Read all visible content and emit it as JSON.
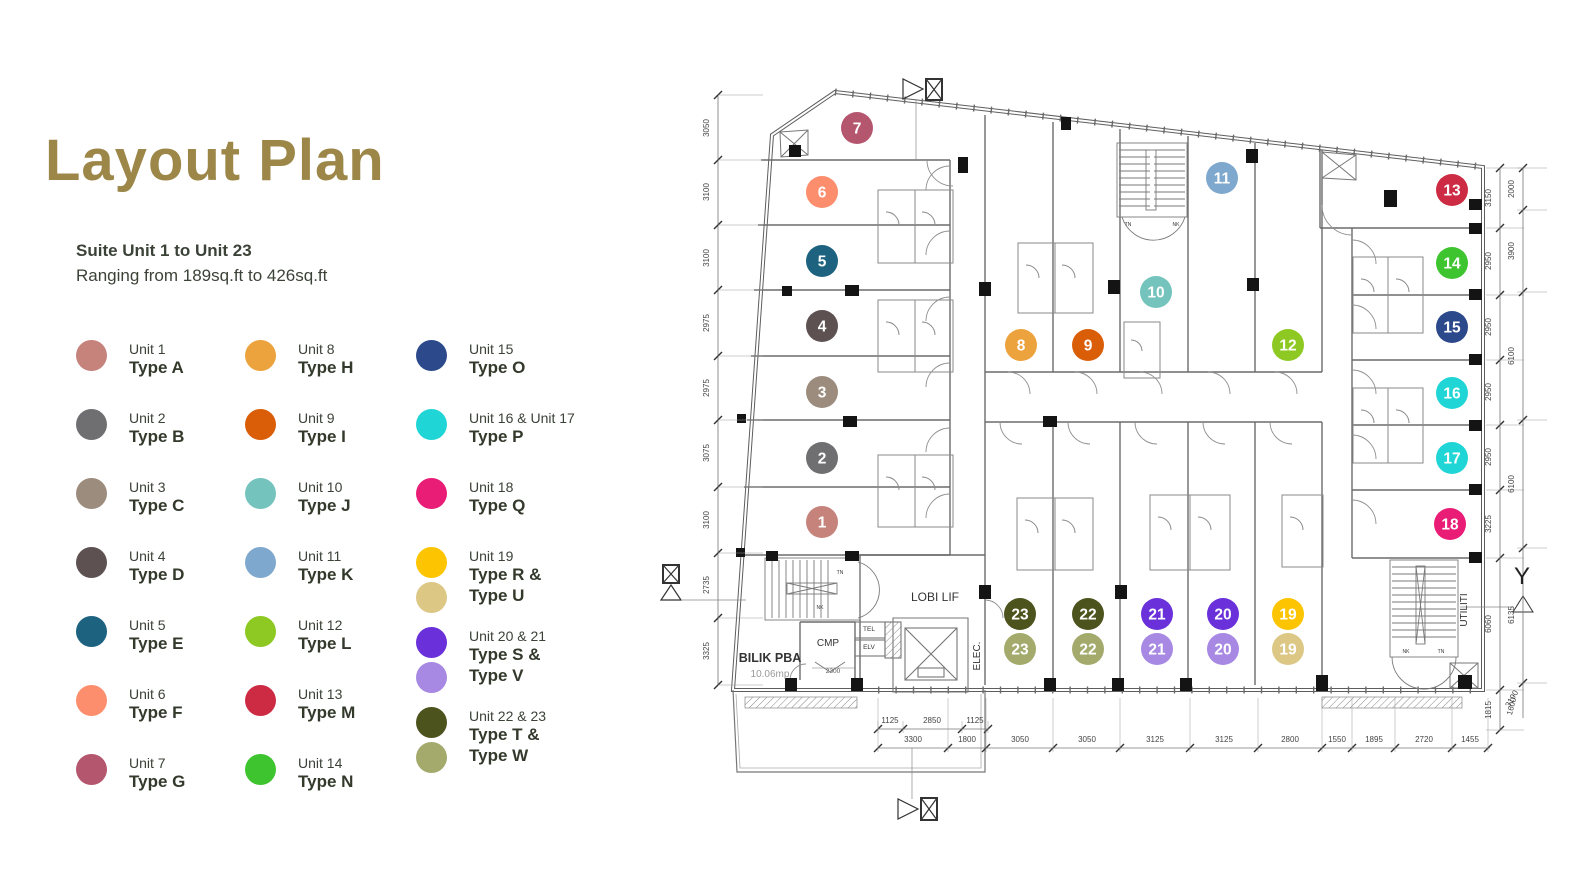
{
  "title": "Layout Plan",
  "title_color": "#9c8748",
  "subtitle": {
    "line1": "Suite Unit 1 to Unit 23",
    "line2": "Ranging from 189sq.ft to 426sq.ft"
  },
  "legend": {
    "columns": [
      [
        {
          "unit": "Unit 1",
          "types": [
            "Type A"
          ],
          "colors": [
            "#c5837b"
          ]
        },
        {
          "unit": "Unit 2",
          "types": [
            "Type B"
          ],
          "colors": [
            "#6f6f71"
          ]
        },
        {
          "unit": "Unit 3",
          "types": [
            "Type C"
          ],
          "colors": [
            "#9c8c7e"
          ]
        },
        {
          "unit": "Unit 4",
          "types": [
            "Type D"
          ],
          "colors": [
            "#5d5152"
          ]
        },
        {
          "unit": "Unit 5",
          "types": [
            "Type E"
          ],
          "colors": [
            "#1d6380"
          ]
        },
        {
          "unit": "Unit 6",
          "types": [
            "Type F"
          ],
          "colors": [
            "#fc8e6e"
          ]
        },
        {
          "unit": "Unit 7",
          "types": [
            "Type G"
          ],
          "colors": [
            "#b5566f"
          ]
        }
      ],
      [
        {
          "unit": "Unit 8",
          "types": [
            "Type H"
          ],
          "colors": [
            "#eca33d"
          ]
        },
        {
          "unit": "Unit 9",
          "types": [
            "Type I"
          ],
          "colors": [
            "#da5d08"
          ]
        },
        {
          "unit": "Unit 10",
          "types": [
            "Type J"
          ],
          "colors": [
            "#74c3bc"
          ]
        },
        {
          "unit": "Unit 11",
          "types": [
            "Type K"
          ],
          "colors": [
            "#7ea8cd"
          ]
        },
        {
          "unit": "Unit 12",
          "types": [
            "Type L"
          ],
          "colors": [
            "#8dc922"
          ]
        },
        {
          "unit": "Unit 13",
          "types": [
            "Type M"
          ],
          "colors": [
            "#cd2b43"
          ]
        },
        {
          "unit": "Unit 14",
          "types": [
            "Type N"
          ],
          "colors": [
            "#3ec42f"
          ]
        }
      ],
      [
        {
          "unit": "Unit 15",
          "types": [
            "Type O"
          ],
          "colors": [
            "#2c4a8b"
          ]
        },
        {
          "unit": "Unit 16 & Unit 17",
          "types": [
            "Type P"
          ],
          "colors": [
            "#20d5d5"
          ]
        },
        {
          "unit": "Unit 18",
          "types": [
            "Type Q"
          ],
          "colors": [
            "#e91d76"
          ]
        },
        {
          "unit": "Unit 19",
          "types": [
            "Type R &",
            "Type U"
          ],
          "colors": [
            "#fdc501",
            "#dcc785"
          ]
        },
        {
          "unit": "Unit 20 & 21",
          "types": [
            "Type S &",
            "Type V"
          ],
          "colors": [
            "#6a31da",
            "#a788e2"
          ]
        },
        {
          "unit": "Unit 22 & 23",
          "types": [
            "Type T &",
            "Type W"
          ],
          "colors": [
            "#4d531d",
            "#a4aa6c"
          ]
        }
      ]
    ]
  },
  "plan": {
    "markers": [
      {
        "n": "1",
        "x": 822,
        "y": 522,
        "c": "#c5837b"
      },
      {
        "n": "2",
        "x": 822,
        "y": 458,
        "c": "#6f6f71"
      },
      {
        "n": "3",
        "x": 822,
        "y": 392,
        "c": "#9c8c7e"
      },
      {
        "n": "4",
        "x": 822,
        "y": 326,
        "c": "#5d5152"
      },
      {
        "n": "5",
        "x": 822,
        "y": 261,
        "c": "#1d6380"
      },
      {
        "n": "6",
        "x": 822,
        "y": 192,
        "c": "#fc8e6e"
      },
      {
        "n": "7",
        "x": 857,
        "y": 128,
        "c": "#b5566f"
      },
      {
        "n": "8",
        "x": 1021,
        "y": 345,
        "c": "#eca33d"
      },
      {
        "n": "9",
        "x": 1088,
        "y": 345,
        "c": "#da5d08"
      },
      {
        "n": "10",
        "x": 1156,
        "y": 292,
        "c": "#74c3bc"
      },
      {
        "n": "11",
        "x": 1222,
        "y": 178,
        "c": "#7ea8cd"
      },
      {
        "n": "12",
        "x": 1288,
        "y": 345,
        "c": "#8dc922"
      },
      {
        "n": "13",
        "x": 1452,
        "y": 190,
        "c": "#cd2b43"
      },
      {
        "n": "14",
        "x": 1452,
        "y": 263,
        "c": "#3ec42f"
      },
      {
        "n": "15",
        "x": 1452,
        "y": 327,
        "c": "#2c4a8b"
      },
      {
        "n": "16",
        "x": 1452,
        "y": 393,
        "c": "#20d5d5"
      },
      {
        "n": "17",
        "x": 1452,
        "y": 458,
        "c": "#20d5d5"
      },
      {
        "n": "18",
        "x": 1450,
        "y": 524,
        "c": "#e91d76"
      },
      {
        "n": "19",
        "x": 1288,
        "y": 614,
        "c": "#fdc501"
      },
      {
        "n": "19",
        "x": 1288,
        "y": 649,
        "c": "#dcc785"
      },
      {
        "n": "20",
        "x": 1223,
        "y": 614,
        "c": "#6a31da"
      },
      {
        "n": "20",
        "x": 1223,
        "y": 649,
        "c": "#a788e2"
      },
      {
        "n": "21",
        "x": 1157,
        "y": 614,
        "c": "#6a31da"
      },
      {
        "n": "21",
        "x": 1157,
        "y": 649,
        "c": "#a788e2"
      },
      {
        "n": "22",
        "x": 1088,
        "y": 614,
        "c": "#4d531d"
      },
      {
        "n": "22",
        "x": 1088,
        "y": 649,
        "c": "#a4aa6c"
      },
      {
        "n": "23",
        "x": 1020,
        "y": 614,
        "c": "#4d531d"
      },
      {
        "n": "23",
        "x": 1020,
        "y": 649,
        "c": "#a4aa6c"
      }
    ],
    "labels": [
      {
        "t": "LOBI LIF",
        "x": 935,
        "y": 601,
        "s": 12
      },
      {
        "t": "CMP",
        "x": 828,
        "y": 646,
        "s": 10
      },
      {
        "t": "TEL",
        "x": 869,
        "y": 631,
        "s": 6.5
      },
      {
        "t": "ELV",
        "x": 869,
        "y": 649,
        "s": 6.5
      },
      {
        "t": "BILIK PBA",
        "x": 770,
        "y": 662,
        "s": 12.5,
        "w": "bold"
      },
      {
        "t": "10.06mp",
        "x": 770,
        "y": 677,
        "s": 10,
        "c": "#9a9a9a"
      },
      {
        "t": "2300",
        "x": 833,
        "y": 673,
        "s": 6.5,
        "c": "#555"
      },
      {
        "t": "ELEC.",
        "x": 980,
        "y": 656,
        "s": 10,
        "rot": -90
      },
      {
        "t": "UTILITI",
        "x": 1467,
        "y": 610,
        "s": 10,
        "rot": -90
      },
      {
        "t": "Y",
        "x": 1522,
        "y": 584,
        "s": 24,
        "c": "#222"
      },
      {
        "t": "TN",
        "x": 1128,
        "y": 226,
        "s": 5
      },
      {
        "t": "NK",
        "x": 1176,
        "y": 226,
        "s": 5
      },
      {
        "t": "TN",
        "x": 840,
        "y": 574,
        "s": 5
      },
      {
        "t": "NK",
        "x": 820,
        "y": 609,
        "s": 5
      },
      {
        "t": "NK",
        "x": 1406,
        "y": 653,
        "s": 5
      },
      {
        "t": "TN",
        "x": 1441,
        "y": 653,
        "s": 5
      }
    ],
    "dims": {
      "left": {
        "dir": "v",
        "x": 718,
        "y1": 95,
        "y2": 685,
        "ext": [
          0,
          27
        ],
        "ticks": [
          95,
          160,
          225,
          290,
          356,
          420,
          487,
          553,
          618,
          685
        ],
        "labels": [
          {
            "v": "3050",
            "p": 128
          },
          {
            "v": "3100",
            "p": 192
          },
          {
            "v": "3100",
            "p": 258
          },
          {
            "v": "2975",
            "p": 323
          },
          {
            "v": "2975",
            "p": 388
          },
          {
            "v": "3075",
            "p": 453
          },
          {
            "v": "3100",
            "p": 520
          },
          {
            "v": "2735",
            "p": 585
          },
          {
            "v": "3325",
            "p": 651
          }
        ]
      },
      "right_inner": {
        "dir": "v",
        "x": 1500,
        "y1": 168,
        "y2": 730,
        "ext": [
          -14,
          6
        ],
        "ticks": [
          168,
          228,
          295,
          360,
          425,
          490,
          558,
          690,
          730
        ],
        "labels": [
          {
            "v": "3150",
            "p": 198
          },
          {
            "v": "2950",
            "p": 261
          },
          {
            "v": "2950",
            "p": 327
          },
          {
            "v": "2950",
            "p": 392
          },
          {
            "v": "2950",
            "p": 457
          },
          {
            "v": "3225",
            "p": 524
          },
          {
            "v": "6060",
            "p": 624
          },
          {
            "v": "1815",
            "p": 710
          }
        ]
      },
      "right_outer": {
        "dir": "v",
        "x": 1523,
        "y1": 168,
        "y2": 718,
        "ext": [
          -6,
          6
        ],
        "ticks": [
          168,
          210,
          292,
          420,
          548,
          683
        ],
        "labels": [
          {
            "v": "2000",
            "p": 189
          },
          {
            "v": "3900",
            "p": 251
          },
          {
            "v": "6100",
            "p": 356
          },
          {
            "v": "6100",
            "p": 484
          },
          {
            "v": "6135",
            "p": 615
          },
          {
            "v": "3190",
            "p": 700,
            "rot": -60
          },
          {
            "v": "1600",
            "p": 707,
            "rot": -75
          }
        ]
      },
      "bottom_upper": {
        "dir": "h",
        "y": 729,
        "x1": 878,
        "x2": 988,
        "ext": [
          -8,
          4
        ],
        "ticks": [
          878,
          903,
          962,
          988
        ],
        "labels": [
          {
            "v": "1125",
            "p": 890
          },
          {
            "v": "2850",
            "p": 932
          },
          {
            "v": "1125",
            "p": 975
          }
        ]
      },
      "bottom_lower": {
        "dir": "h",
        "y": 748,
        "x1": 878,
        "x2": 1490,
        "ext": [
          -50,
          4
        ],
        "ticks": [
          878,
          948,
          986,
          1053,
          1120,
          1190,
          1258,
          1322,
          1352,
          1395,
          1452,
          1488
        ],
        "labels": [
          {
            "v": "3300",
            "p": 913
          },
          {
            "v": "1800",
            "p": 967
          },
          {
            "v": "3050",
            "p": 1020
          },
          {
            "v": "3050",
            "p": 1087
          },
          {
            "v": "3125",
            "p": 1155
          },
          {
            "v": "3125",
            "p": 1224
          },
          {
            "v": "2800",
            "p": 1290
          },
          {
            "v": "1550",
            "p": 1337
          },
          {
            "v": "1895",
            "p": 1374
          },
          {
            "v": "2720",
            "p": 1424
          },
          {
            "v": "1455",
            "p": 1470
          }
        ]
      }
    }
  }
}
